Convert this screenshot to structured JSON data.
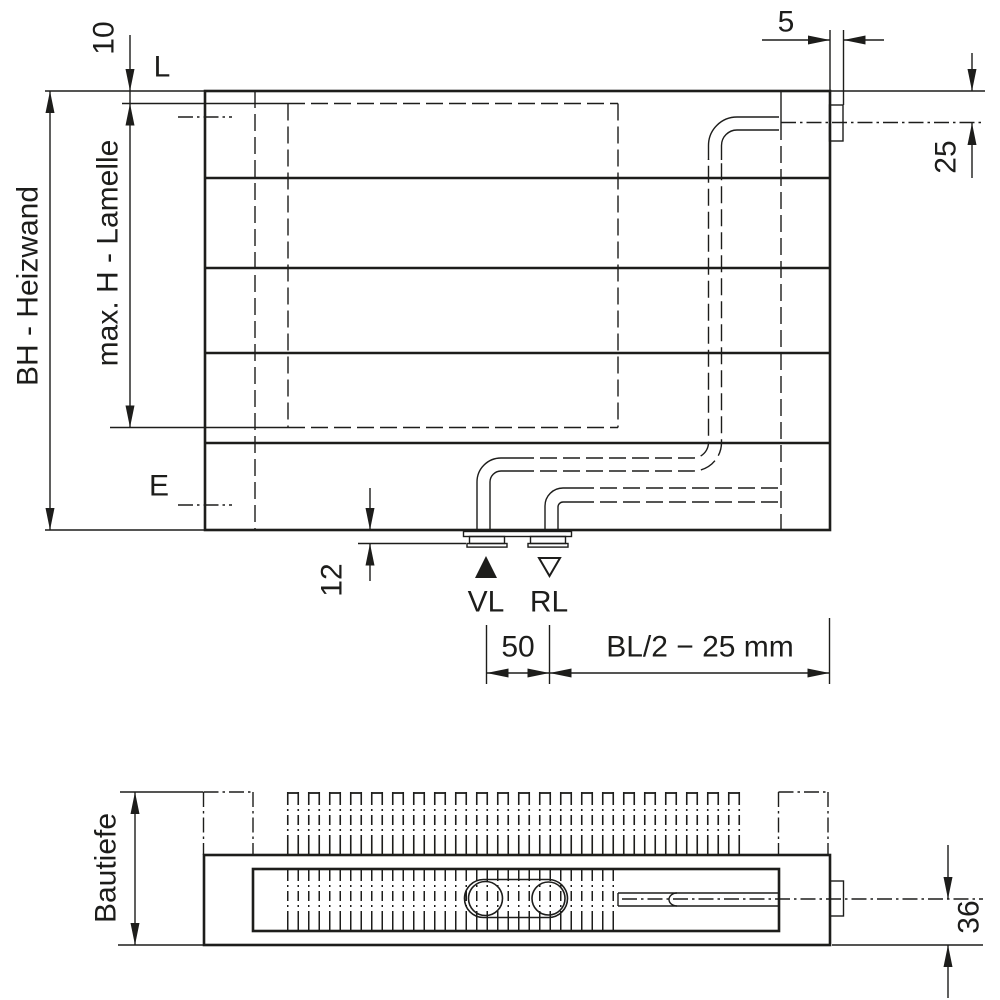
{
  "colors": {
    "line": "#1d1d1b",
    "background": "#ffffff"
  },
  "front_view": {
    "dim_top_offset": "10",
    "label_top_connection": "L",
    "dim_build_height": "BH - Heizwand",
    "dim_max_lamella_height": "max. H - Lamelle",
    "label_bottom_connection": "E",
    "dim_bottom_offset": "12",
    "dim_tab_width": "5",
    "dim_connection_from_top": "25",
    "label_supply": "VL",
    "label_return": "RL",
    "dim_connection_spacing": "50",
    "dim_half_length": "BL/2 − 25 mm"
  },
  "bottom_view": {
    "dim_depth": "Bautiefe",
    "dim_connection_from_bottom": "36"
  }
}
